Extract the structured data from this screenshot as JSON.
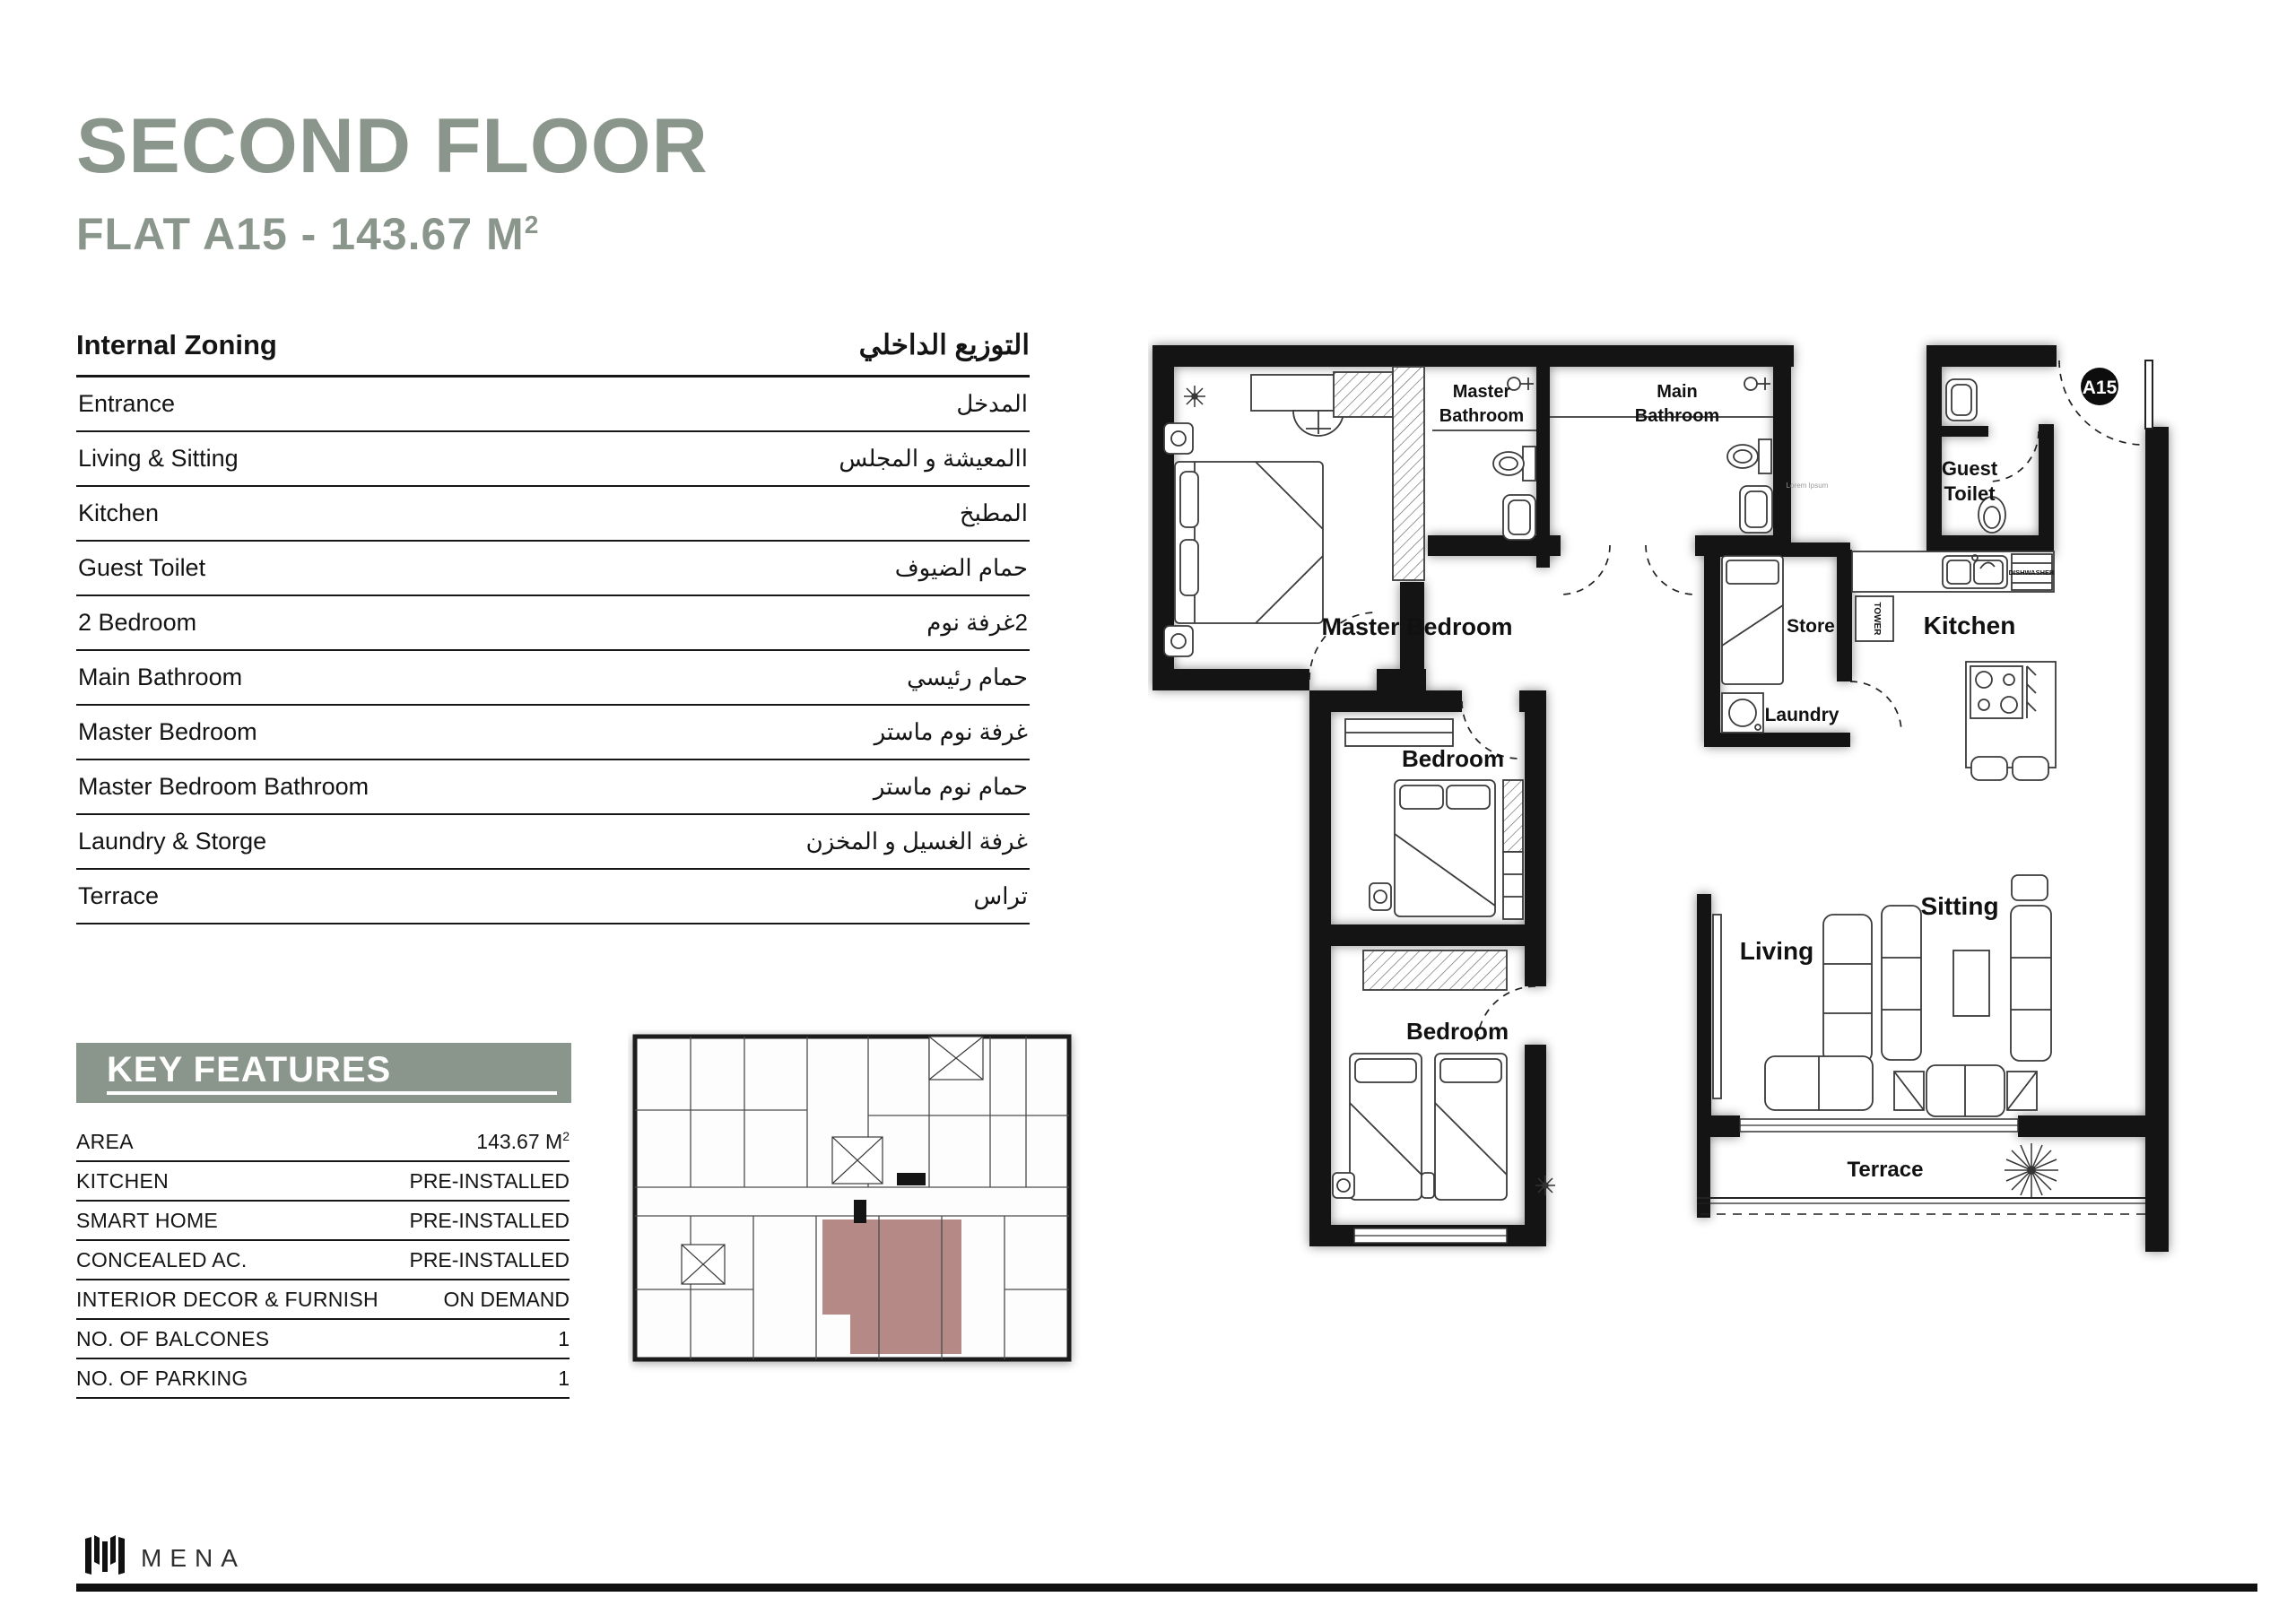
{
  "header": {
    "title": "SECOND FLOOR",
    "subtitle": "FLAT A15 - 143.67 M",
    "sup": "2"
  },
  "internal_zoning": {
    "title_en": "Internal Zoning",
    "title_ar": "التوزيع الداخلي",
    "rows": [
      {
        "en": "Entrance",
        "ar": "المدخل"
      },
      {
        "en": "Living & Sitting",
        "ar": "االمعيشة و المجلس"
      },
      {
        "en": "Kitchen",
        "ar": "المطبخ"
      },
      {
        "en": "Guest Toilet",
        "ar": "حمام الضيوف"
      },
      {
        "en": "2 Bedroom",
        "ar": "2غرفة نوم"
      },
      {
        "en": "Main Bathroom",
        "ar": "حمام رئيسي"
      },
      {
        "en": "Master Bedroom",
        "ar": "غرفة نوم ماستر"
      },
      {
        "en": "Master Bedroom Bathroom",
        "ar": "حمام نوم ماستر"
      },
      {
        "en": "Laundry & Storge",
        "ar": "غرفة الغسيل و المخزن"
      },
      {
        "en": "Terrace",
        "ar": "تراس"
      }
    ]
  },
  "key_features": {
    "title": "KEY FEATURES",
    "rows": [
      {
        "label": "AREA",
        "value": "143.67 M",
        "sup": "2"
      },
      {
        "label": "KITCHEN",
        "value": "PRE-INSTALLED"
      },
      {
        "label": "SMART HOME",
        "value": "PRE-INSTALLED"
      },
      {
        "label": "CONCEALED AC.",
        "value": "PRE-INSTALLED"
      },
      {
        "label": "INTERIOR DECOR & FURNISH",
        "value": "ON DEMAND"
      },
      {
        "label": "NO. OF BALCONES",
        "value": "1"
      },
      {
        "label": "NO. OF PARKING",
        "value": "1"
      }
    ]
  },
  "floor_plan": {
    "badge": "A15",
    "watermark": "Lorem Ipsum",
    "rooms": {
      "master_bedroom": "Master Bedroom",
      "master_bath_1": "Master",
      "master_bath_2": "Bathroom",
      "main_bath_1": "Main",
      "main_bath_2": "Bathroom",
      "guest_1": "Guest",
      "guest_2": "Toilet",
      "store": "Store",
      "laundry": "Laundry",
      "kitchen": "Kitchen",
      "bedroom_a": "Bedroom",
      "bedroom_b": "Bedroom",
      "living": "Living",
      "sitting": "Sitting",
      "terrace": "Terrace"
    },
    "appliances": {
      "tower": "TOWER",
      "dishwasher": "DISHWASHER"
    }
  },
  "footer": {
    "brand": "MENA"
  },
  "colors": {
    "accent": "#8a958c",
    "highlight": "#a5706b",
    "wall": "#141414"
  }
}
